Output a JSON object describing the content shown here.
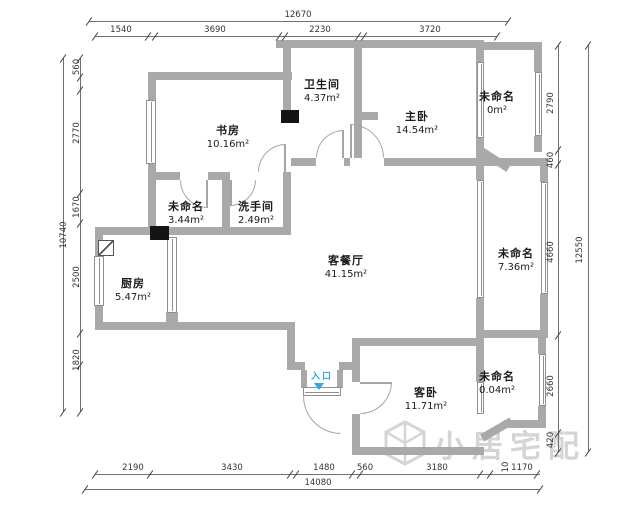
{
  "rooms": [
    {
      "id": "study",
      "name": "书房",
      "area": "10.16m²"
    },
    {
      "id": "bathroom",
      "name": "卫生间",
      "area": "4.37m²"
    },
    {
      "id": "master-bedroom",
      "name": "主卧",
      "area": "14.54m²"
    },
    {
      "id": "unnamed-top-right",
      "name": "未命名",
      "area": "0m²"
    },
    {
      "id": "unnamed-mid-left",
      "name": "未命名",
      "area": "3.44m²"
    },
    {
      "id": "washroom",
      "name": "洗手间",
      "area": "2.49m²"
    },
    {
      "id": "living-dining",
      "name": "客餐厅",
      "area": "41.15m²"
    },
    {
      "id": "unnamed-right-balcony",
      "name": "未命名",
      "area": "7.36m²"
    },
    {
      "id": "kitchen",
      "name": "厨房",
      "area": "5.47m²"
    },
    {
      "id": "guest-bedroom",
      "name": "客卧",
      "area": "11.71m²"
    },
    {
      "id": "unnamed-bottom-right",
      "name": "未命名",
      "area": "0.04m²"
    }
  ],
  "entrance": {
    "label": "入口"
  },
  "dimensions": {
    "top": {
      "total": "12670",
      "segments": [
        "1540",
        "3690",
        "2230",
        "3720"
      ]
    },
    "left": {
      "total": "10740",
      "segments": [
        "560",
        "2770",
        "1670",
        "2500",
        "1820"
      ]
    },
    "right": {
      "total": "12550",
      "segments": [
        "2790",
        "460",
        "4660",
        "2660",
        "420"
      ]
    },
    "bottom": {
      "total": "14080",
      "segments": [
        "2190",
        "3430",
        "1480",
        "560",
        "3180",
        "10",
        "1170"
      ]
    }
  },
  "watermark": {
    "text": "小居宅配"
  },
  "colors": {
    "wall": "#a9a9a9",
    "entrance_blue": "#2ea8de",
    "dimension_text": "#333333",
    "watermark": "#c7c7c7"
  }
}
